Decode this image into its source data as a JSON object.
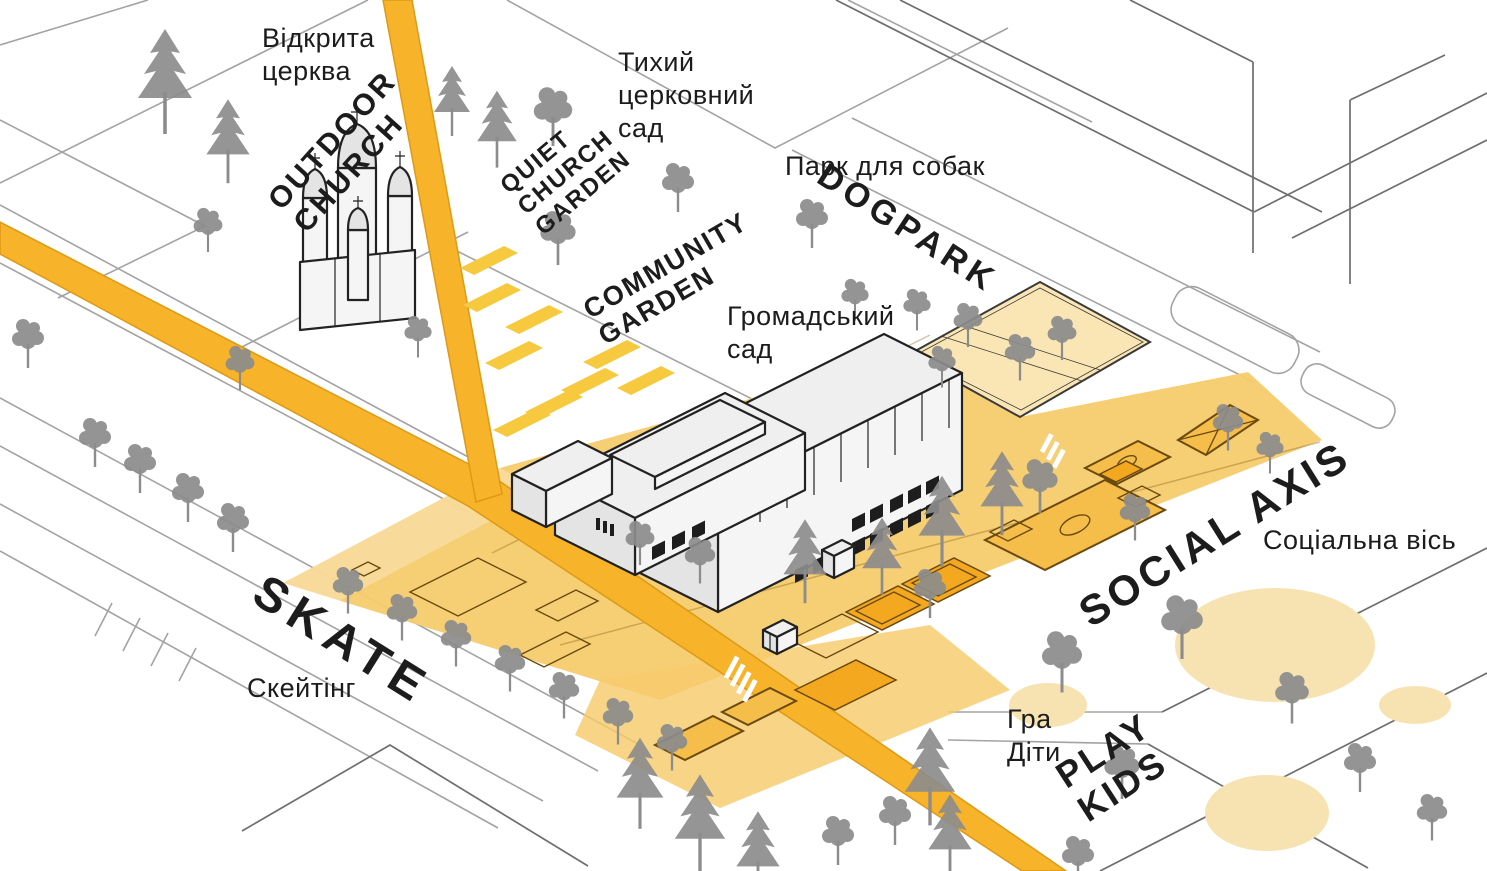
{
  "labels": {
    "outdoor_church": {
      "uk": "Відкрита церква",
      "en": "OUTDOOR CHURCH"
    },
    "quiet_church_garden": {
      "uk": "Тихий церковний сад",
      "en": "QUIET CHURCH GARDEN"
    },
    "dogpark": {
      "uk": "Парк для собак",
      "en": "DOGPARK"
    },
    "community_garden": {
      "uk": "Громадський сад",
      "en": "COMMUNITY GARDEN"
    },
    "social_axis": {
      "uk": "Соціальна вісь",
      "en": "SOCIAL AXIS"
    },
    "skate": {
      "uk": "Скейтінг",
      "en": "SKATE"
    },
    "play_kids": {
      "uk": "Гра Діти",
      "en": "PLAY KIDS"
    }
  },
  "palette": {
    "road": "#F7B32A",
    "road_edge": "#DD9A15",
    "strip": "#F6CB6C",
    "dogpark": "#FAE5B4",
    "plot": "#F6C93E",
    "court": "#F5BD49",
    "court2": "#F3A81F",
    "court_line": "#6B4A10",
    "ellipse": "#F7E3B2",
    "tree": "#8C8C8C",
    "line": "#A3A3A3",
    "line2": "#6E6E6E",
    "outline": "#222222",
    "bwall": "#F5F5F5",
    "bside": "#E4E4E4",
    "broof": "#EFEFEF",
    "text": "#1C1C1C"
  }
}
